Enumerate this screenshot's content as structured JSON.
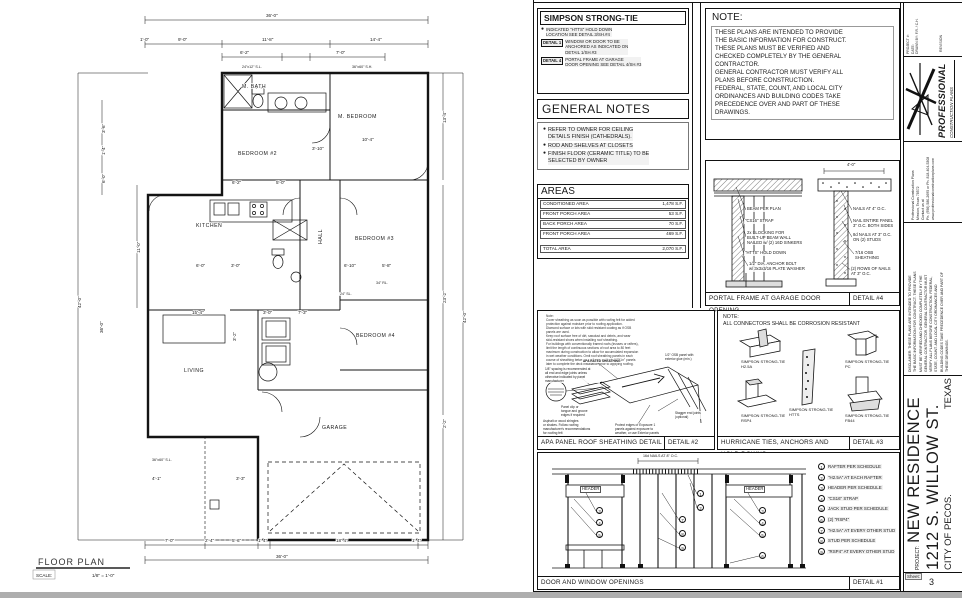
{
  "plan": {
    "title": "FLOOR PLAN",
    "scale_label": "SCALE:",
    "scale_value": "1/8\" = 1'-0\"",
    "rooms": {
      "m_bath": "M. BATH",
      "m_bedroom": "M. BEDROOM",
      "bedroom2": "BEDROOM #2",
      "kitchen": "KITCHEN",
      "hall": "HALL",
      "bedroom3": "BEDROOM #3",
      "bedroom4": "BEDROOM #4",
      "living": "LIVING",
      "garage": "GARAGE"
    },
    "dims": {
      "d36": "36'-0\"",
      "d1_0": "1'-0\"",
      "d9_0": "9'-0\"",
      "d11_8": "11'-8\"",
      "d14_4": "14'-4\"",
      "d6_2": "6'-2\"",
      "d7_0": "7'-0\"",
      "b7_0": "7'-0\"",
      "b2_4": "2'-4\"",
      "b5_6": "5'-6\"",
      "b1_4a": "1'-4\"",
      "b18_4": "18'-4\"",
      "b1_4b": "1'-4\"",
      "b36": "36'-0\"",
      "l3_6": "3'-6\"",
      "l1_4": "1'-4\"",
      "l6_0": "6'-0\"",
      "l11_0": "11'-0\"",
      "l42": "42'-0\"",
      "l36": "36'-0\"",
      "r13_4": "13'-4\"",
      "r23_2": "23'-2\"",
      "r2_2": "2'-2\"",
      "r42": "42'-0\"",
      "m3_10": "3'-10\"",
      "m10_4": "10'-4\"",
      "m5_0": "5'-0\"",
      "m6_2": "6'-2\"",
      "m6_0": "6'-0\"",
      "m3_0a": "3'-0\"",
      "m15_4": "15'-4\"",
      "m3_0b": "3'-0\"",
      "m7_3": "7'-3\"",
      "m6_10": "6'-10\"",
      "m5_8": "5'-8\"",
      "m4_1": "4'-1\"",
      "m3_3": "3'-3\"",
      "m3_2": "3'-2\""
    },
    "windows": {
      "w1": "24\"x12\" S.L.",
      "w2": "36\"x60\" S.H.",
      "w3": "36\"x60\" S.L.",
      "w4": "24\" SL.",
      "w5": "34\" RL."
    }
  },
  "simpson": {
    "title": "SIMPSON STRONG-TIE",
    "items": [
      {
        "tag": "",
        "text": "INDICATED \"HTTS\" HOLD DOWN\nLOCATION SEE DETAIL 3/SH.#4"
      },
      {
        "tag": "DETAIL 1",
        "text": "WINDOW OR DOOR TO BE\nANCHORED AS INDICATED ON\nDETAIL 1/SH.#3"
      },
      {
        "tag": "DETAIL 4",
        "text": "PORTAL FRAME AT GARAGE\nDOOR OPENING SEE DETAIL 4/SH.#3"
      }
    ]
  },
  "general_notes": {
    "title": "GENERAL NOTES",
    "items": [
      "REFER TO OWNER FOR CEILING\nDETAILS FINISH (CATHEDRALS).",
      "ROD AND SHELVES AT CLOSETS",
      "FINISH FLOOR (CERAMIC TITLE) TO BE\nSELECTED BY OWNER"
    ]
  },
  "areas": {
    "title": "AREAS",
    "rows": [
      {
        "label": "CONDITIONED AREA",
        "value": "1,478 S.F."
      },
      {
        "label": "FRONT PORCH AREA",
        "value": "53 S.F."
      },
      {
        "label": "BACK PORCH AREA",
        "value": "70 S.F."
      },
      {
        "label": "FRONT PORCH AREA",
        "value": "469 S.F."
      }
    ],
    "total_label": "TOTAL AREA",
    "total_value": "2,070 S.F."
  },
  "note_box": {
    "title": "NOTE:",
    "body": "THESE PLANS ARE INTENDED TO PROVIDE\nTHE BASIC INFORMATION FOR CONSTRUCT.\nTHESE PLANS MUST BE VERIFIED AND\nCHECKED COMPLETELY BY THE GENERAL\nCONTRACTOR.\nGENERAL CONTRACTOR MUST VERIFY ALL\nPLANS BEFORE CONSTRUCTION.\nFEDERAL, STATE, COUNT, AND LOCAL CITY\nORDINANCES AND BUILDING CODES TAKE\nPRECEDENCE OVER AND PART OF THESE\nDRAWINGS."
  },
  "portal": {
    "title": "PORTAL FRAME AT GARAGE DOOR OPENING",
    "detail": "DETAIL #4",
    "dim": "4'-0\"",
    "beam": "BEAM PER PLAN",
    "strap": "\"CS16\" STRAP",
    "blocking": "2x BLOCKING FOR\nBUILT-UP BEAM WALL\nNAILED w/ (2) 16D SINKERS",
    "holddown": "\"HTTS\" HOLD DOWN",
    "anchor": "1/2\" DIA. ANCHOR BOLT\nw/ 3x3x3/16 PLATE WASHER",
    "nails4": "NAILS AT 4\" O.C.",
    "nail_entire": "NAIL ENTIRE PANEL\n3\" O.C. BOTH SIDES",
    "nails8d": "8d NAILS AT 3\" O.C.\nON (2) STUDS",
    "osb": "7/16 OSB SHEATHING",
    "rows_nails": "(2) ROWS OF NAILS\nAT 3\" O.C."
  },
  "apa": {
    "title": "APA PANEL ROOF SHEATHING DETAIL",
    "detail": "DETAIL #2",
    "notes": "Note:\nCover sheathing as soon as possible with roofing felt for added\nprotection against moisture prior to roofing application.\nDiamond surface or lots with skid resistant coating as if OSB\npanels are used.\nKeep roof surface free of dirt, sawdust and debris, and wear\nskid-resistant shoes when installing roof sheathing.\nFor buildings with conventionally framed roofs (trusses or rafters),\nlimit the length of continuous sections of roof area to 80 feet\nmaximum during construction to allow for accumulated expansion\nin wet weather conditions. Omit roof sheathing panels in each\ncourse of sheathing between sections, and install \"fill-in\" panels\nlater to complete the deck installation prior to applying roofing.",
    "lbl_rated": "APA RATED SHEATHING",
    "lbl_spacing": "1/8\" spacing is recommended at\nall end and edge joints unless\notherwise indicated by panel\nmanufacturer",
    "lbl_clip": "Panel clip or\ntongue and groove\nedges if required",
    "lbl_shingles": "Asphalt or wood shingles\nor shakes. Follow roofing\nmanufacturer's recommendations\nfor roofing felt",
    "lbl_osb": "1/2\" OSB panel with\nexterior glue (min.)",
    "lbl_stagger": "Stagger end joints\n(optional)",
    "lbl_protect": "Protect edges of Exposure 1\npanels against exposure to\nweather, or use Exterior panels"
  },
  "hurricane": {
    "title": "HURRICANE TIES, ANCHORS AND HOLD DOWNS",
    "detail": "DETAIL #3",
    "note": "NOTE:\nALL CONNECTORS SHALL BE CORROSION RESISTANT",
    "connectors": [
      {
        "name": "SIMPSON STRONG-TIE\nH2.5A"
      },
      {
        "name": "SIMPSON STRONG-TIE\nPC"
      },
      {
        "name": "SIMPSON STRONG-TIE\nHTTS"
      },
      {
        "name": "SIMPSON STRONG-TIE\nRSP4"
      },
      {
        "name": "SIMPSON STRONG-TIE\nFB44"
      }
    ]
  },
  "openings": {
    "title": "DOOR AND WINDOW OPENINGS",
    "detail": "DETAIL #1",
    "header_label": "HEADER",
    "top_note": "16d NAILS AT 8\" O.C.",
    "legend": [
      {
        "num": "1",
        "text": "RAFTER PER SCHEDULE"
      },
      {
        "num": "2",
        "text": "\"H2.5A\" AT EACH RAFTER"
      },
      {
        "num": "3",
        "text": "HEADER PER SCHEDULE"
      },
      {
        "num": "4",
        "text": "\"CS16\" STRAP"
      },
      {
        "num": "5",
        "text": "JACK STUD PER SCHEDULE"
      },
      {
        "num": "6",
        "text": "(2) \"RSP4\""
      },
      {
        "num": "7",
        "text": "\"H2.5A\" AT EVERY OTHER STUD"
      },
      {
        "num": "8",
        "text": "STUD PER  SCHEDULE"
      },
      {
        "num": "9",
        "text": "\"RSP4\" AT EVERY OTHER STUD"
      }
    ]
  },
  "titleblock": {
    "meta": "PROJECT #:\nDATE:\nDRAWN BY: F.R. / C.H.",
    "revision": "REVISION",
    "brand_top": "PROFESSIONAL",
    "brand_bottom": "CONSTRUCTION PLANS",
    "contact": "Professional Construction Plans\nMission, Texas 78572\nContact us at\nPh. (956) 580-2695 or Ph. 818-404-5308\nwww.professionalconstructionplans.com",
    "disclaimer": "DISCLAIMER: THESE PLANS ARE INTENDED TO PROVIDE\nTHE BASIC INFORMATION FOR CONSTRUCT. THESE PLANS\nMUST BE VERIFIED AND CHECKED COMPLETELY BY THE\nGENERAL CONTRACTOR. GENERAL CONTRACTOR MUST\nVERIFY ALL PLANS BEFORE CONSTRUCTION. FEDERAL,\nSTATE, COUNT. AND LOCAL CITY ORDINANCES AND\nBUILDING CODES TAKE PRECEDENCE OVER AND PART OF\nTHESE DRAWINGS.",
    "project_label": "PROJECT:",
    "project_line1": "NEW RESIDENCE",
    "project_line2": "1212 S. WILLOW ST.",
    "city": "CITY OF PECOS.",
    "state": "TEXAS",
    "sheet_label": "Sheet:",
    "sheet_number": "3"
  }
}
